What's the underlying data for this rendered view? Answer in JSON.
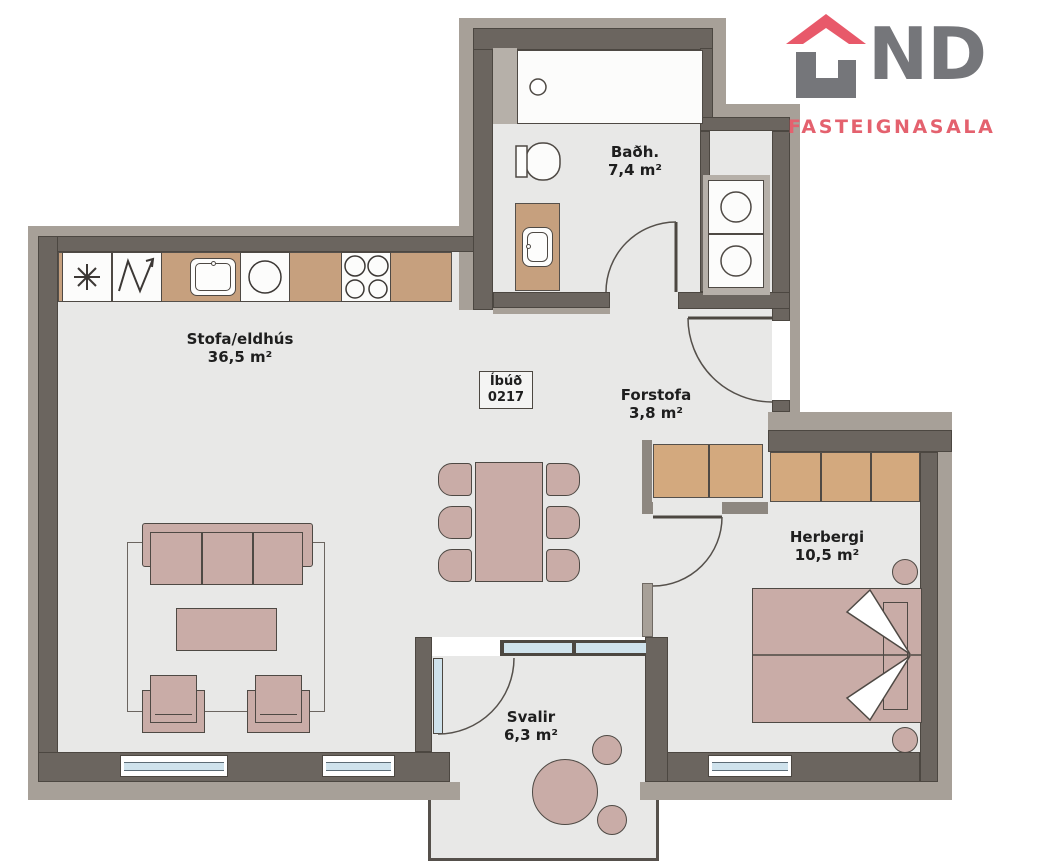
{
  "brand": {
    "name": "LIND",
    "letters_after_icon": "ND",
    "subtitle": "FASTEIGNASALA",
    "gray": "#75767a",
    "red": "#e8596a"
  },
  "unit": {
    "label": "Íbúð",
    "number": "0217"
  },
  "rooms": {
    "living": {
      "name": "Stofa/eldhús",
      "area": "36,5 m²"
    },
    "bathroom": {
      "name": "Baðh.",
      "area": "7,4 m²"
    },
    "hallway": {
      "name": "Forstofa",
      "area": "3,8 m²"
    },
    "bedroom": {
      "name": "Herbergi",
      "area": "10,5 m²"
    },
    "balcony": {
      "name": "Svalir",
      "area": "6,3 m²"
    }
  },
  "colors": {
    "wall_dark": "#6b655f",
    "wall_light": "#a7a098",
    "floor": "#e8e8e7",
    "wood": "#c6a07e",
    "wardrobe": "#d3a97e",
    "furniture": "#c9aca7",
    "glass": "#cfe2ec"
  }
}
